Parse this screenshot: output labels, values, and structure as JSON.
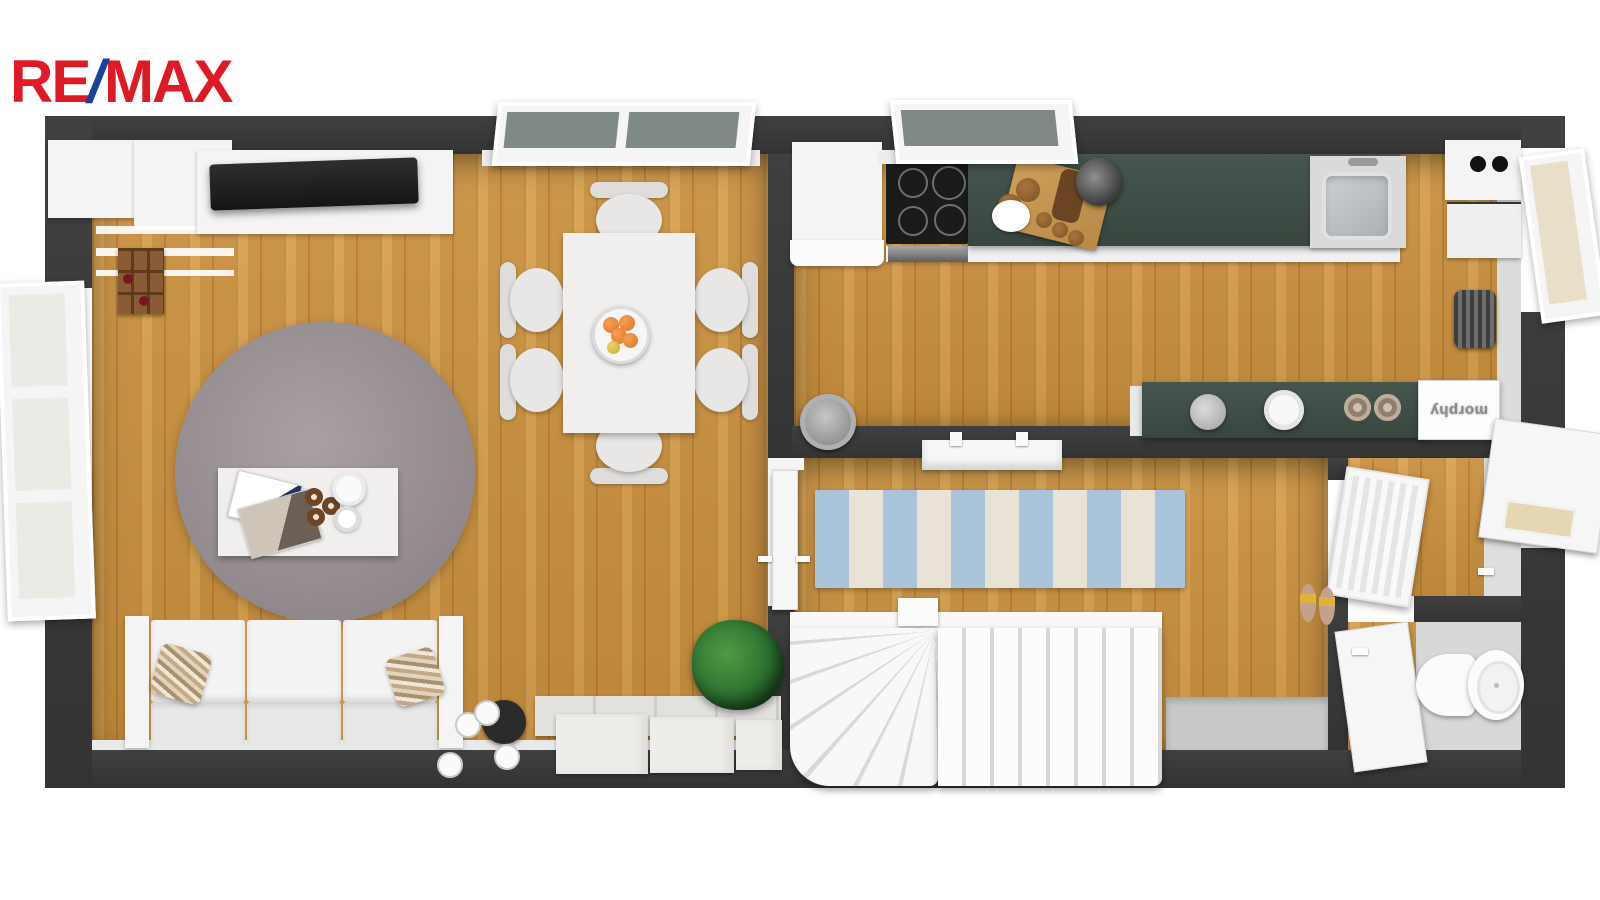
{
  "logo": {
    "re": "RE",
    "slash": "/",
    "max": "MAX",
    "red": "#e01a24",
    "blue": "#16439c"
  },
  "appliance_box": {
    "label": "morphy"
  },
  "plan": {
    "type": "3d-top-view-floor-plan",
    "rooms": [
      {
        "name": "living-dining-room",
        "floor": "wood"
      },
      {
        "name": "kitchen",
        "floor": "wood"
      },
      {
        "name": "hallway",
        "floor": "wood"
      },
      {
        "name": "entrance",
        "floor": "wood"
      },
      {
        "name": "wc",
        "floor": "wood"
      }
    ],
    "colors": {
      "wall": "#3a3a3a",
      "wood_floor": "#cf9a4c",
      "kitchen_counter_green": "#3f5049",
      "round_rug_gray": "#9a9295",
      "runner_blue": "#a9c3da",
      "runner_cream": "#e8e3d6",
      "furniture_white": "#f4f4f4",
      "plant_green": "#2e7d32",
      "orange_fruit": "#e8863a",
      "tv_black": "#242424"
    },
    "items": [
      "wall-cabinets",
      "tv",
      "wine-rack",
      "round-rug",
      "coffee-table",
      "magazines",
      "teapot",
      "donuts",
      "sofa",
      "pillows",
      "floor-lamp",
      "dining-table",
      "dining-chairs",
      "fruit-bowl",
      "storage-boxes",
      "potted-plant",
      "fridge",
      "cooktop",
      "green-counter",
      "cutting-board",
      "kettle",
      "sink",
      "boiler",
      "green-shelf",
      "mugs",
      "microwave-box",
      "radiator",
      "waste-pot",
      "striped-runner-rug",
      "hall-radiator",
      "winder-staircase",
      "glass-door",
      "front-door",
      "wc-door",
      "toilet",
      "slippers",
      "open-windows"
    ]
  }
}
